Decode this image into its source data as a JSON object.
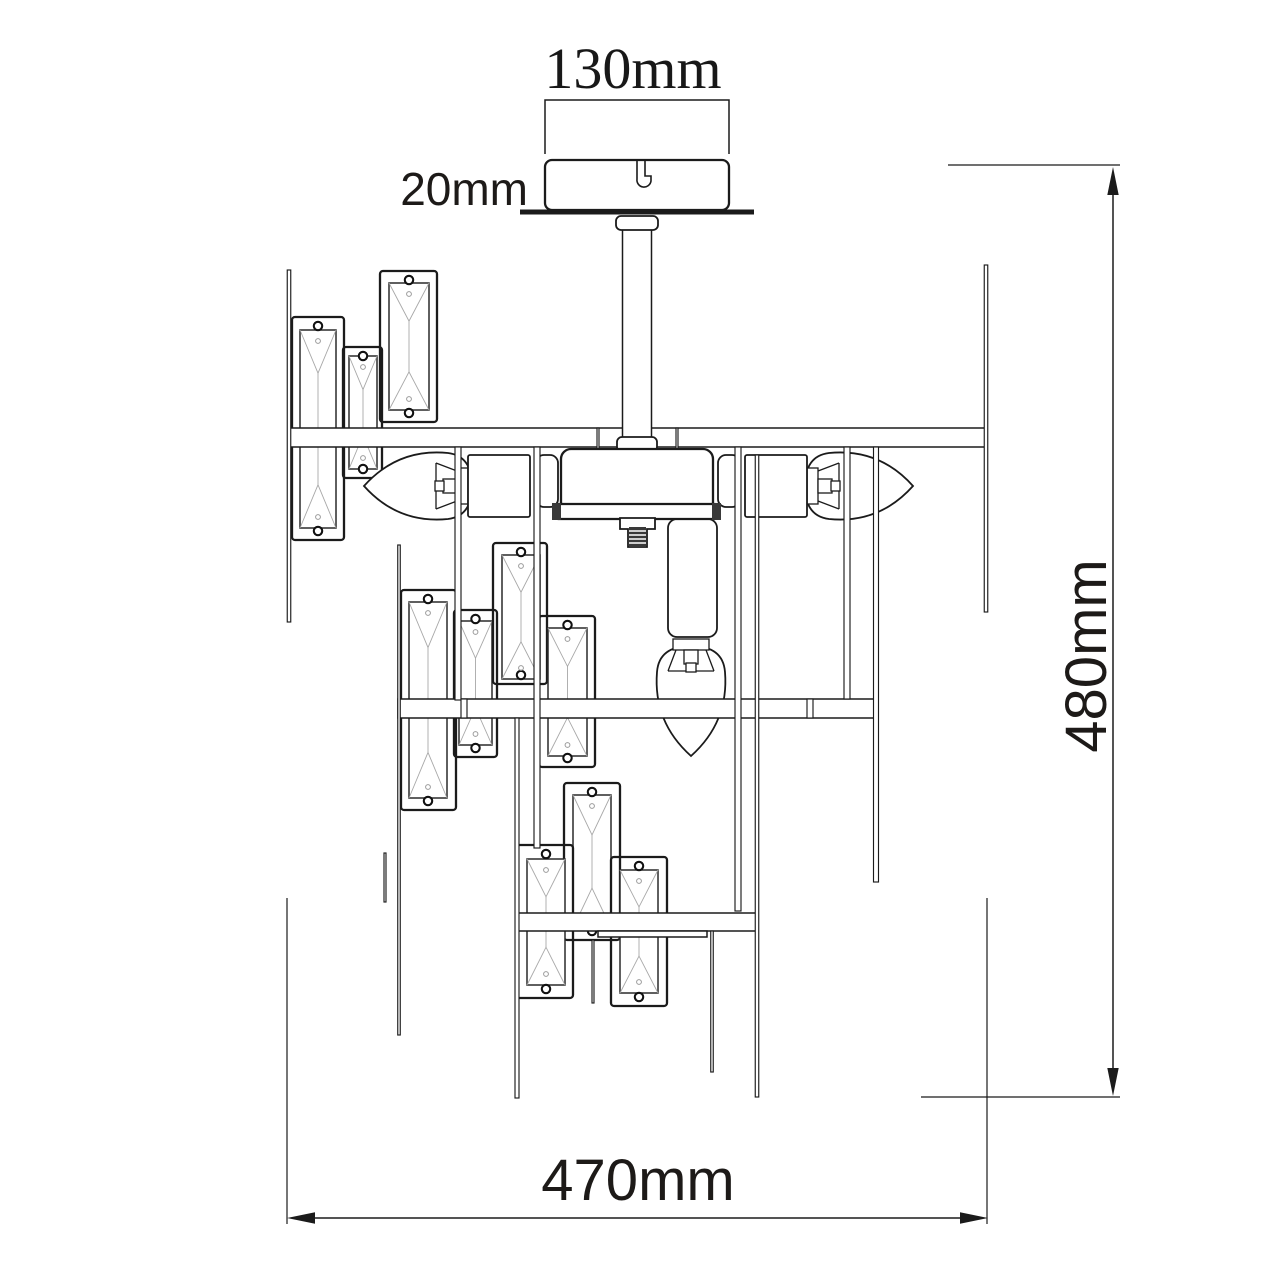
{
  "page": {
    "width": 1280,
    "height": 1280,
    "background": "#ffffff",
    "description": "Technical dimension drawing of a crystal chandelier, front elevation"
  },
  "palette": {
    "ink": "#1b1b1b",
    "bevel_gray": "#a8a8a8",
    "thread_fill": "#3a3a3a",
    "paper": "#ffffff"
  },
  "dimensions": {
    "canopy_width": {
      "label": "130mm"
    },
    "canopy_height": {
      "label": "20mm"
    },
    "overall_height": {
      "label": "480mm"
    },
    "overall_width": {
      "label": "470mm"
    }
  },
  "drawing": {
    "crystals": [
      {
        "f": [
          292,
          317,
          52,
          223
        ],
        "c": [
          300,
          330,
          36,
          198
        ]
      },
      {
        "f": [
          343,
          347,
          39,
          131
        ],
        "c": [
          349,
          356,
          28,
          113
        ]
      },
      {
        "f": [
          380,
          271,
          57,
          151
        ],
        "c": [
          389,
          283,
          40,
          127
        ]
      },
      {
        "f": [
          401,
          590,
          55,
          220
        ],
        "c": [
          409,
          602,
          38,
          196
        ]
      },
      {
        "f": [
          454,
          610,
          43,
          147
        ],
        "c": [
          459,
          621,
          33,
          124
        ]
      },
      {
        "f": [
          493,
          543,
          54,
          141
        ],
        "c": [
          502,
          555,
          38,
          124
        ]
      },
      {
        "f": [
          539,
          616,
          56,
          151
        ],
        "c": [
          548,
          628,
          39,
          128
        ]
      },
      {
        "f": [
          564,
          783,
          56,
          157
        ],
        "c": [
          573,
          795,
          38,
          133
        ]
      },
      {
        "f": [
          516,
          845,
          57,
          153
        ],
        "c": [
          527,
          859,
          38,
          126
        ]
      },
      {
        "f": [
          611,
          857,
          56,
          149
        ],
        "c": [
          620,
          870,
          38,
          123
        ]
      }
    ],
    "bars": [
      [
        289,
        428,
        697,
        19
      ],
      [
        398,
        699,
        480,
        19
      ],
      [
        517,
        913,
        240,
        18
      ],
      [
        598,
        931,
        109,
        6
      ]
    ],
    "rods": [
      [
        289,
        270,
        622,
        3.5
      ],
      [
        986,
        265,
        612,
        3.5
      ],
      [
        399,
        545,
        1035,
        2.5
      ],
      [
        385,
        853,
        902,
        2
      ],
      [
        458,
        447,
        700,
        6
      ],
      [
        537,
        447,
        848,
        6
      ],
      [
        517,
        718,
        1098,
        4
      ],
      [
        757,
        455,
        1097,
        3.5
      ],
      [
        738,
        447,
        911,
        6
      ],
      [
        847,
        447,
        699,
        6
      ],
      [
        876,
        447,
        882,
        5
      ],
      [
        712,
        931,
        1072,
        2.5
      ],
      [
        593,
        940,
        1003,
        2
      ],
      [
        464,
        699,
        718,
        6
      ],
      [
        810,
        699,
        718,
        6
      ],
      [
        598,
        428,
        450,
        2
      ],
      [
        677,
        428,
        450,
        2
      ]
    ],
    "flanges": [
      [
        536,
        455,
        22,
        52
      ],
      [
        718,
        455,
        22,
        52
      ]
    ],
    "sockets": [
      {
        "r": [
          468,
          455,
          62,
          62
        ],
        "rx": 2
      },
      {
        "r": [
          745,
          455,
          62,
          62
        ],
        "rx": 2
      },
      {
        "r": [
          668,
          519,
          49,
          118
        ],
        "rx": 9
      }
    ],
    "bulbs": [
      {
        "name": "candle-bulb-left",
        "path": "M364,486 Q398,448 448,453 Q472,456 472,486 Q472,516 448,519 Q398,524 364,486 Z",
        "holder": {
          "x": 468,
          "y": 486,
          "rot": 180
        }
      },
      {
        "name": "candle-bulb-right",
        "path": "M913,486 Q879,448 829,453 Q805,456 805,486 Q805,516 829,519 Q879,524 913,486 Z",
        "holder": {
          "x": 807,
          "y": 486,
          "rot": 0
        }
      },
      {
        "name": "candle-bulb-bottom",
        "path": "M691,756 Q653,722 657,672 Q659,646 691,646 Q723,646 725,672 Q729,722 691,756 Z",
        "holder": {
          "x": 691,
          "y": 639,
          "rot": 90
        }
      }
    ],
    "hub": {
      "body": [
        561,
        449,
        152,
        63
      ],
      "rim": [
        555,
        504,
        163,
        15
      ],
      "caps": [
        [
          552,
          503,
          9,
          17
        ],
        [
          712,
          503,
          9,
          17
        ]
      ]
    },
    "stem": {
      "x1": 622.5,
      "x2": 651.5,
      "y1": 230,
      "y2": 440,
      "collar_top": [
        616,
        216,
        42,
        14
      ],
      "collar_bottom": [
        617,
        437,
        40,
        15
      ]
    },
    "canopy": {
      "body": [
        545,
        160,
        184,
        50
      ],
      "hook": "M637,161 v18 a7,7 0 0 0 14,2 v-5 h-6 v-15"
    },
    "plate": {
      "x1": 520,
      "x2": 754,
      "y": 212
    },
    "screw": {
      "bracket": "M620,518 h35 v11 h-8 v18 h-19 v-18 h-8 Z",
      "thread": [
        629,
        527,
        17,
        20
      ]
    }
  }
}
